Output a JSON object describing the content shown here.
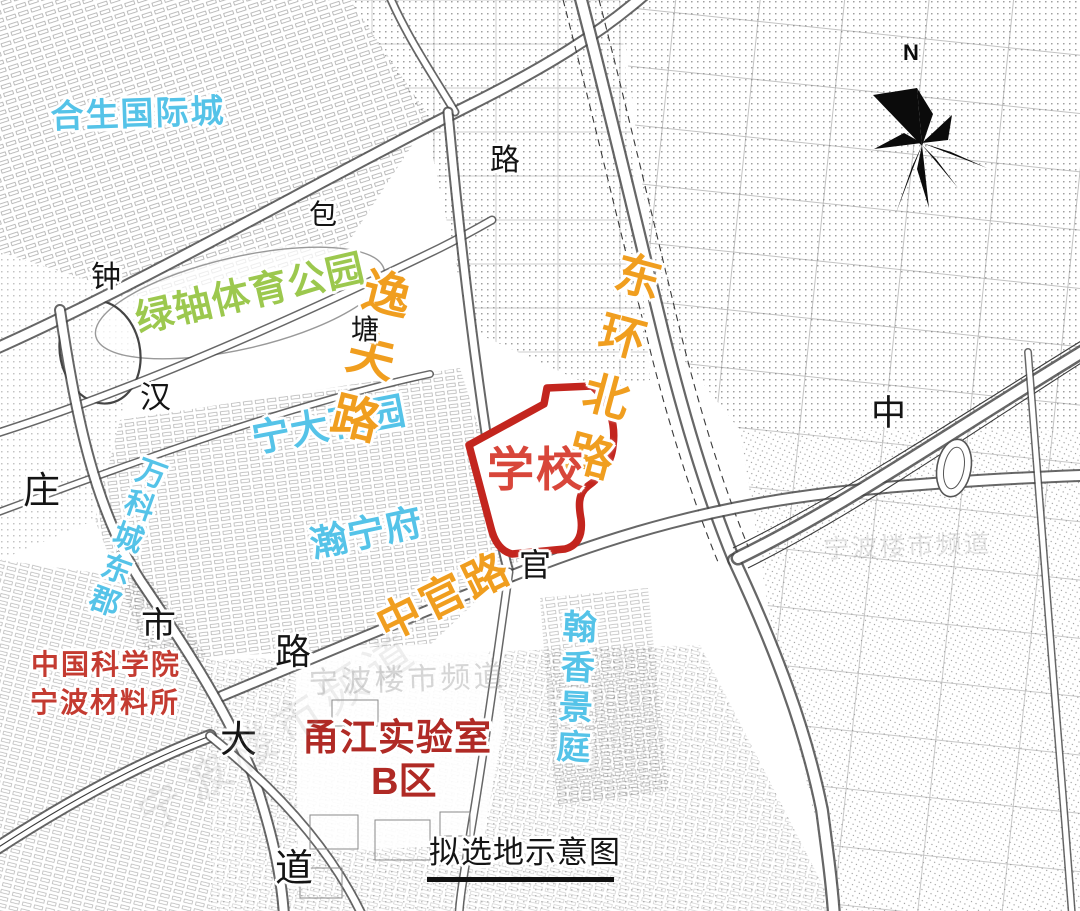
{
  "title": "拟选地示意图",
  "colors": {
    "orange": "#f09e1f",
    "cyan": "#55c3e8",
    "green": "#9cc84e",
    "red_school": "#d8463a",
    "red_site_stroke": "#c3251e",
    "red_cas": "#c43b31",
    "red_lab": "#b02a25",
    "ink": "#141414",
    "watermark": "#9a9a9a"
  },
  "compass": {
    "n": "N"
  },
  "site": {
    "label": "学校"
  },
  "labels": [
    {
      "name": "label-hesheng-intl-city",
      "text": "合生国际城",
      "x": 50,
      "y": 100,
      "size": 33,
      "color": "cyan",
      "rot": -2,
      "ls": 2,
      "bold": true
    },
    {
      "name": "label-green-axis-sports-park",
      "text": "绿轴体育公园",
      "x": 132,
      "y": 302,
      "size": 38,
      "color": "green",
      "rot": -13,
      "ls": 1,
      "bold": true
    },
    {
      "name": "label-ningda-garden",
      "text": "宁大花园",
      "x": 249,
      "y": 422,
      "size": 38,
      "color": "cyan",
      "rot": -11,
      "ls": 1,
      "bold": true
    },
    {
      "name": "label-hanningfu",
      "text": "瀚宁府",
      "x": 307,
      "y": 527,
      "size": 37,
      "color": "cyan",
      "rot": -12,
      "ls": 1,
      "bold": true
    },
    {
      "name": "label-wanke-east",
      "text": "万科城东郡",
      "x": 139,
      "y": 452,
      "size": 30,
      "color": "cyan",
      "rot": 20,
      "ls": 4,
      "bold": true,
      "vert": true
    },
    {
      "name": "label-hanxiang-jingting",
      "text": "翰香景庭",
      "x": 559,
      "y": 608,
      "size": 34,
      "color": "cyan",
      "rot": 3,
      "ls": 6,
      "bold": true,
      "vert": true
    },
    {
      "name": "label-yifu-road",
      "text": "逸夫路",
      "x": 363,
      "y": 262,
      "size": 48,
      "color": "orange",
      "rot": 14,
      "ls": 16,
      "bold": true,
      "vert": true
    },
    {
      "name": "label-donghuan-north-road",
      "text": "东环北路",
      "x": 618,
      "y": 246,
      "size": 46,
      "color": "orange",
      "rot": 15,
      "ls": 16,
      "bold": true,
      "vert": true
    },
    {
      "name": "label-zhongguan-road",
      "text": "中官路",
      "x": 370,
      "y": 608,
      "size": 44,
      "color": "orange",
      "rot": -26,
      "ls": 4,
      "bold": true
    },
    {
      "name": "label-school-site",
      "text": "学校",
      "x": 487,
      "y": 446,
      "size": 47,
      "color": "red_school",
      "rot": 0,
      "ls": 2,
      "bold": true
    },
    {
      "name": "label-cas-line1",
      "text": "中国科学院",
      "x": 31,
      "y": 650,
      "size": 28,
      "color": "red_cas",
      "rot": 0,
      "ls": 2,
      "bold": true
    },
    {
      "name": "label-cas-line2",
      "text": "宁波材料所",
      "x": 30,
      "y": 688,
      "size": 28,
      "color": "red_cas",
      "rot": 0,
      "ls": 2,
      "bold": true
    },
    {
      "name": "label-yongjiang-lab",
      "text": "甬江实验室",
      "x": 302,
      "y": 719,
      "size": 37,
      "color": "red_lab",
      "rot": 0,
      "ls": 1,
      "bold": true
    },
    {
      "name": "label-yongjiang-lab-zone-b",
      "text": "B区",
      "x": 371,
      "y": 763,
      "size": 38,
      "color": "red_lab",
      "rot": 0,
      "ls": 0,
      "bold": true
    },
    {
      "name": "caption-site-selection",
      "text": "拟选地示意图",
      "x": 429,
      "y": 837,
      "size": 31,
      "color": "ink",
      "rot": 0,
      "ls": 1,
      "serif": true
    },
    {
      "name": "roadchar-lu-top",
      "text": "路",
      "x": 490,
      "y": 145,
      "size": 30,
      "color": "ink",
      "serif": true
    },
    {
      "name": "roadchar-bao",
      "text": "包",
      "x": 309,
      "y": 201,
      "size": 28,
      "color": "ink",
      "serif": true
    },
    {
      "name": "roadchar-zhong-bell",
      "text": "钟",
      "x": 91,
      "y": 262,
      "size": 30,
      "color": "ink",
      "serif": true
    },
    {
      "name": "roadchar-tang",
      "text": "塘",
      "x": 351,
      "y": 316,
      "size": 28,
      "color": "ink",
      "serif": true
    },
    {
      "name": "roadchar-han",
      "text": "汉",
      "x": 140,
      "y": 382,
      "size": 31,
      "color": "ink",
      "serif": true
    },
    {
      "name": "roadchar-zhuang",
      "text": "庄",
      "x": 23,
      "y": 473,
      "size": 37,
      "color": "ink",
      "serif": true
    },
    {
      "name": "roadchar-shi",
      "text": "市",
      "x": 141,
      "y": 608,
      "size": 35,
      "color": "ink",
      "serif": true
    },
    {
      "name": "roadchar-lu-mid",
      "text": "路",
      "x": 275,
      "y": 634,
      "size": 36,
      "color": "ink",
      "serif": true
    },
    {
      "name": "roadchar-da",
      "text": "大",
      "x": 220,
      "y": 722,
      "size": 37,
      "color": "ink",
      "serif": true
    },
    {
      "name": "roadchar-dao",
      "text": "道",
      "x": 275,
      "y": 850,
      "size": 38,
      "color": "ink",
      "serif": true
    },
    {
      "name": "roadchar-guan",
      "text": "官",
      "x": 519,
      "y": 549,
      "size": 32,
      "color": "ink",
      "serif": true
    },
    {
      "name": "roadchar-zhong-mid",
      "text": "中",
      "x": 871,
      "y": 396,
      "size": 35,
      "color": "ink",
      "serif": true
    },
    {
      "name": "watermark-1",
      "text": "宁波楼市频道",
      "x": 308,
      "y": 668,
      "size": 30,
      "color": "watermark",
      "rot": -2,
      "ls": 3,
      "opacity": 0.4
    },
    {
      "name": "watermark-2",
      "text": "宁波楼市频道",
      "x": 823,
      "y": 536,
      "size": 26,
      "color": "watermark",
      "rot": -2,
      "ls": 2,
      "opacity": 0.28
    },
    {
      "name": "watermark-3",
      "text": "宁波楼市频道",
      "x": 130,
      "y": 800,
      "size": 46,
      "color": "watermark",
      "rot": -33,
      "ls": 8,
      "opacity": 0.16
    }
  ]
}
